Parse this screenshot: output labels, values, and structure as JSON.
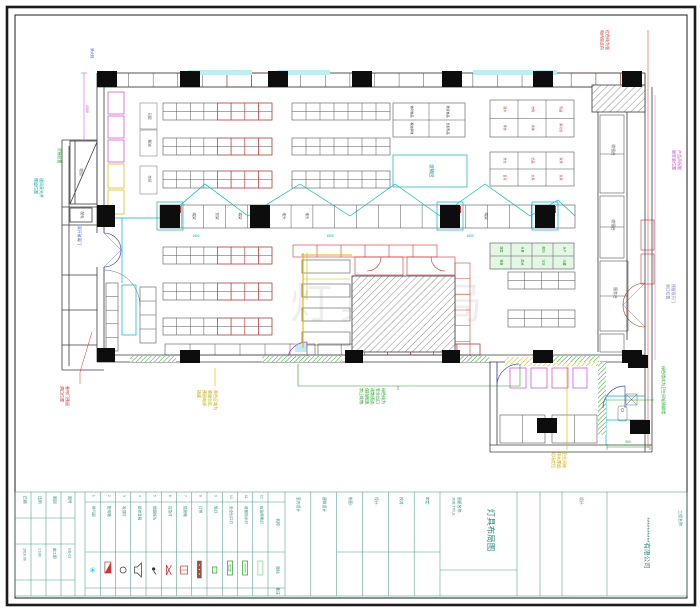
{
  "sheet": {
    "company": "**********有限公司",
    "project_label": "工程名称:",
    "drawing_name": [
      "图纸名称:",
      "JOB TITLE"
    ],
    "drawing_title": "灯具布局图",
    "review_label": "设计:",
    "fields": [
      {
        "label": "日期",
        "value": "2018.06"
      },
      {
        "label": "比例",
        "value": "1:100"
      },
      {
        "label": "图别",
        "value": "施工图"
      },
      {
        "label": "图号",
        "value": "GD-01"
      }
    ],
    "staff": [
      {
        "label": "室内设计"
      },
      {
        "label": "建筑设计"
      },
      {
        "label": "制图:"
      },
      {
        "label": "设计:"
      },
      {
        "label": "校对:"
      },
      {
        "label": "审定:"
      }
    ]
  },
  "legend": {
    "headers": {
      "name": "名称",
      "icon": "图标",
      "note": "备注"
    },
    "items": [
      {
        "no": "1",
        "name": "换气扇",
        "type": "fan"
      },
      {
        "no": "2",
        "name": "配电箱",
        "type": "panel"
      },
      {
        "no": "3",
        "name": "吸顶灯",
        "type": "light"
      },
      {
        "no": "4",
        "name": "壁挂音箱",
        "type": "speaker"
      },
      {
        "no": "5",
        "name": "烟感探头",
        "type": "sensor"
      },
      {
        "no": "6",
        "name": "应急灯",
        "type": "em"
      },
      {
        "no": "7",
        "name": "插座箱",
        "type": "socket"
      },
      {
        "no": "8",
        "name": "灯带",
        "type": "strip"
      },
      {
        "no": "9",
        "name": "筒灯",
        "type": "spot"
      },
      {
        "no": "10",
        "name": "安全出口灯",
        "type": "exitA"
      },
      {
        "no": "11",
        "name": "疏散指示灯",
        "type": "exitB"
      },
      {
        "no": "12",
        "name": "应急照明灯",
        "type": "exitC"
      }
    ]
  },
  "plan": {
    "watermark": "灯具布局",
    "promo": "促销区",
    "ramp": "坡道",
    "power": "配电",
    "mid_cells": [
      "端架",
      "货架",
      "端架",
      "堆头",
      "堆头",
      "端架"
    ],
    "corridor": [
      "收银台",
      "收银台",
      "服务台"
    ],
    "side_labels": [
      "日配",
      "粮油",
      "杂货"
    ],
    "tables": [
      {
        "cells": [
          "休闲食品",
          "散装食品",
          "粮油调味",
          "日配乳品"
        ]
      },
      {
        "cells": [
          "酒水",
          "饮料",
          "乳品",
          "零食",
          "调味",
          "南北货"
        ]
      },
      {
        "cells": [
          "洗化",
          "纸品",
          "家清",
          "百货",
          "文具",
          "玩具"
        ]
      },
      {
        "cells": [
          "蔬菜",
          "水果",
          "鲜肉",
          "水产",
          "熟食",
          "面点",
          "冷冻",
          "冷藏"
        ]
      }
    ]
  },
  "annotations": {
    "cyan_left": [
      "通风采光井",
      "预留位置"
    ],
    "green_left": [
      "货梯位置"
    ],
    "blue_door": [
      "双开玻璃门"
    ],
    "red_left": [
      "卷帘门预留",
      "洞口位置"
    ],
    "yellow_checkout": [
      "黄色区域为",
      "收银台区,",
      "预留电源",
      "插座."
    ],
    "green_exit": [
      "绿色线为",
      "安全出口",
      "疏散通道,",
      "保持畅通,",
      "禁止堆物."
    ],
    "yellow_room": [
      "卫生间给",
      "排水预留,",
      "现场定位."
    ],
    "green_room": [
      "绿色墙体为卫生间轻质隔墙"
    ],
    "red_top": [
      "红色线为强",
      "电桥架走向"
    ],
    "magenta_right": [
      "产品声报警",
      "器安装位置"
    ],
    "purple_door": [
      "预留双开门",
      "洞口位置"
    ],
    "blue_hydrant": "消火栓",
    "dims": {
      "d4500": "4500",
      "d1500": "1500",
      "d900": "900"
    }
  },
  "colors": {
    "wiring_cyan": "#00b4c8",
    "alarm_red": "#cc3333",
    "exit_green": "#22a022",
    "fixture_magenta": "#cc44cc",
    "highlight_yellow": "#ddb400",
    "titleblock_teal": "#4a9a8c"
  }
}
